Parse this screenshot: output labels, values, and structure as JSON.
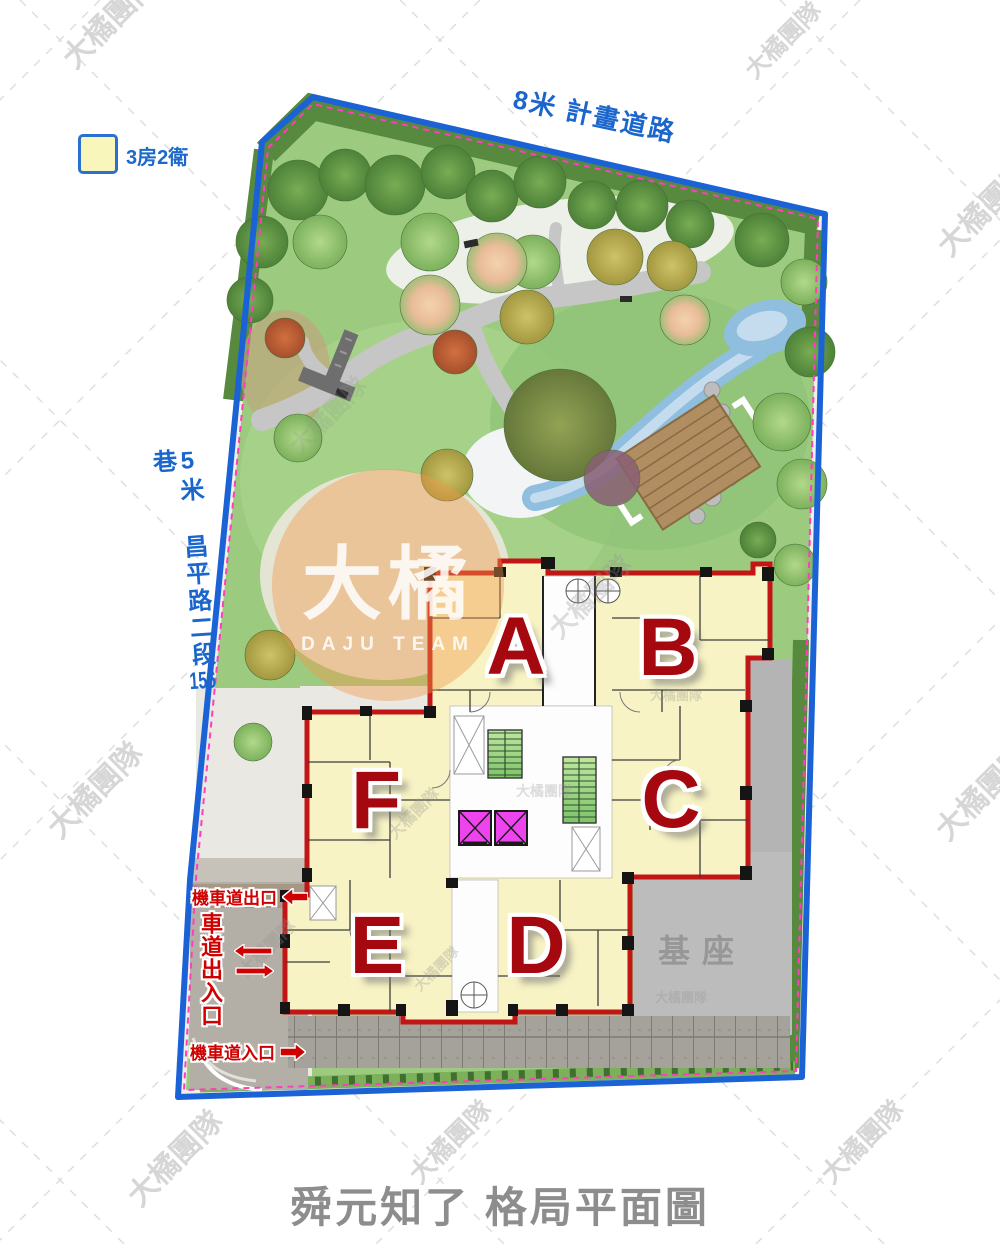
{
  "page": {
    "title": "舜元知了 格局平面圖"
  },
  "legend": {
    "label": "3房2衛",
    "swatch_color": "#f9f6bb"
  },
  "roads": {
    "top": "8米 計畫道路",
    "left_full": "5米 昌平路二段156巷",
    "left_p1": "5米 ",
    "left_p2": "昌平路二段",
    "left_num": "156",
    "left_p3": "巷"
  },
  "access": {
    "moto_exit": "機車道出口",
    "driveway": "車道出入口",
    "moto_entry": "機車道入口"
  },
  "units": [
    "A",
    "B",
    "C",
    "D",
    "E",
    "F"
  ],
  "podium_label": "基座",
  "watermark": {
    "brand": "大橘",
    "team": "DAJU TEAM",
    "corner": "大橘團隊"
  },
  "colors": {
    "boundary_blue": "#1b62d6",
    "setback_pink": "#ff3dbd",
    "road_text_blue": "#1a66cc",
    "unit_letter_red": "#a5090f",
    "access_label_red": "#cf0000",
    "building_wall_red": "#c21616",
    "unit_fill_yellow": "#f7f3c4",
    "podium_gray": "#bcbcbc",
    "elevator_magenta": "#ee44ee",
    "stair_green": "#9fd257",
    "lawn_green": "#9ccb80",
    "watermark_orange": "#f2994a",
    "title_gray": "#8d8d8d"
  }
}
